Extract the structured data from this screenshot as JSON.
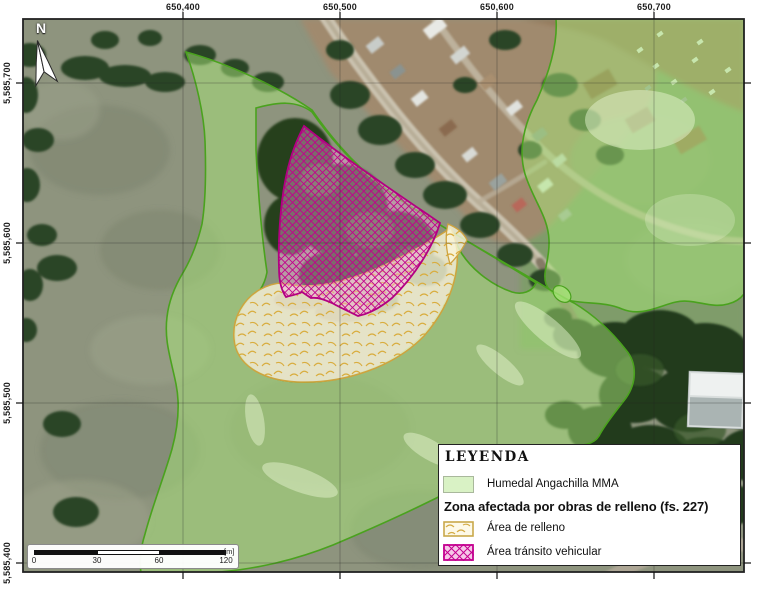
{
  "figure": {
    "north_label": "N",
    "axis": {
      "x_labels": [
        "650,400",
        "650,500",
        "650,600",
        "650,700"
      ],
      "y_labels": [
        "5,585,700",
        "5,585,600",
        "5,585,500",
        "5,585,400"
      ]
    },
    "scale_bar": {
      "tick_labels": [
        "0",
        "30",
        "60",
        "120"
      ],
      "unit_label": "[m]"
    },
    "legend": {
      "title": "LEYENDA",
      "wetland_item": {
        "label": "Humedal Angachilla MMA"
      },
      "affected_header": "Zona afectada por obras de relleno (fs. 227)",
      "relleno_item": {
        "label": "Área de relleno"
      },
      "transito_item": {
        "label": "Área tránsito vehicular"
      }
    },
    "colors": {
      "wetland_fill": "#d9f2c5",
      "wetland_border": "#54a82a",
      "transito_magenta": "#c4008f",
      "relleno_gold": "#c9a84a"
    }
  }
}
